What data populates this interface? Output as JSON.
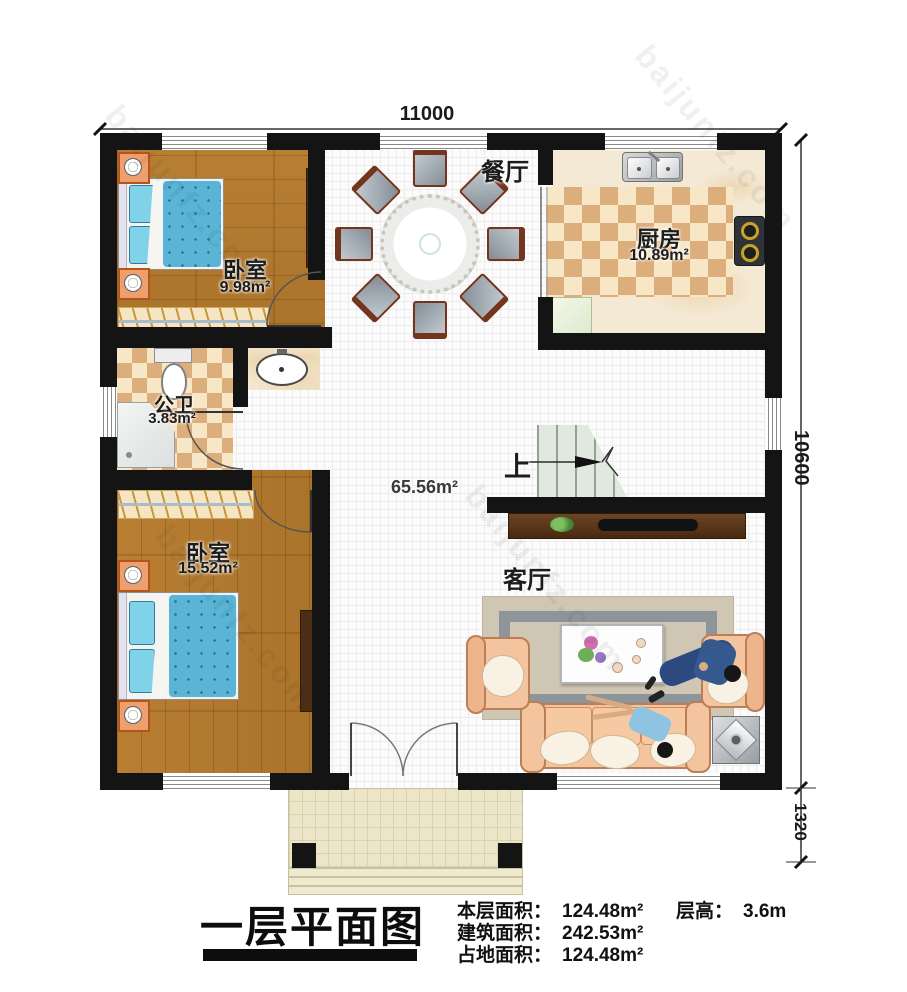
{
  "dimensions": {
    "top": "11000",
    "right": "10600",
    "bottom_right": "1320"
  },
  "rooms": {
    "bedroom1": {
      "name": "卧室",
      "area": "9.98m²"
    },
    "bedroom2": {
      "name": "卧室",
      "area": "15.52m²"
    },
    "kitchen": {
      "name": "厨房",
      "area": "10.89m²"
    },
    "bathroom": {
      "name": "公卫",
      "area": "3.83m²"
    },
    "dining": {
      "name": "餐厅"
    },
    "living": {
      "name": "客厅"
    },
    "hall_area": "65.56m²",
    "stairs_up": "上"
  },
  "title_block": {
    "title": "一层平面图",
    "stats": [
      {
        "label": "本层面积：",
        "value": "124.48m²"
      },
      {
        "label": "建筑面积：",
        "value": "242.53m²"
      },
      {
        "label": "占地面积：",
        "value": "124.48m²"
      }
    ],
    "floor_height": {
      "label": "层高：",
      "value": "3.6m"
    }
  },
  "watermark": {
    "text": "baijunfz.com"
  }
}
